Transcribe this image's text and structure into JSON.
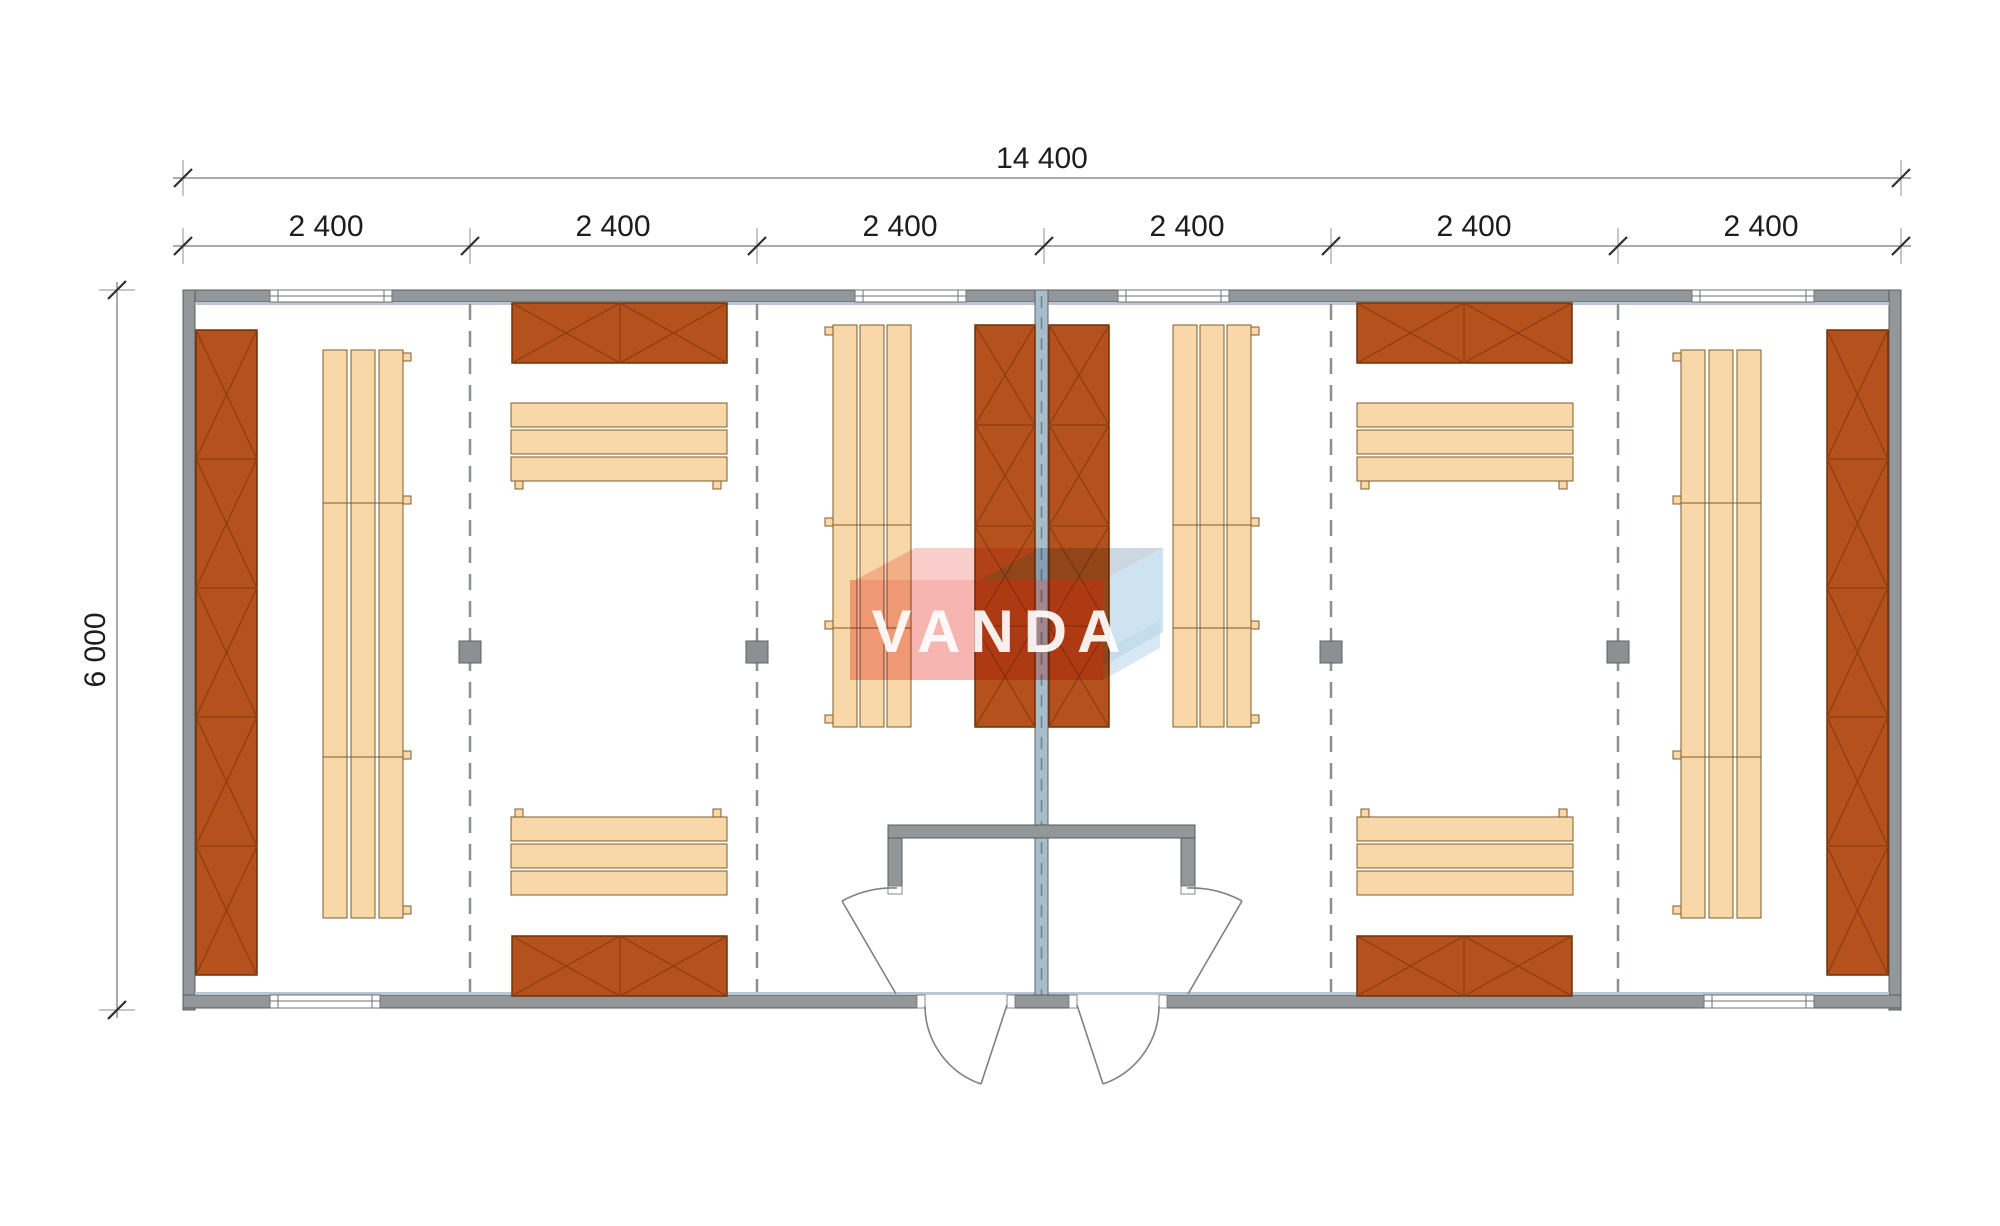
{
  "dimensions": {
    "overall_width": {
      "label": "14 400"
    },
    "modules": [
      {
        "label": "2 400"
      },
      {
        "label": "2 400"
      },
      {
        "label": "2 400"
      },
      {
        "label": "2 400"
      },
      {
        "label": "2 400"
      },
      {
        "label": "2 400"
      }
    ],
    "overall_depth": {
      "label": "6 000"
    }
  },
  "watermark": {
    "text": "VANDA"
  },
  "colors": {
    "wall": "#94979a",
    "wall_outline": "#585b5e",
    "wall_inner_face": "#b8c7d3",
    "party_wall": "#a9bcca",
    "locker_fill": "#b5511c",
    "locker_outline": "#6f3008",
    "bench_fill": "#f8d8a8",
    "bench_outline": "#7d5c28",
    "divider_dash": "#8d9093",
    "dimension_line": "#8f8f8f",
    "dimension_tick": "#2f2f2f",
    "watermark_red": "#ea5c50",
    "watermark_blue": "#bcd9ea"
  },
  "legend": {
    "locker_name": "wardrobe-locker-unit",
    "bench_name": "bench-unit",
    "post_name": "structural-post",
    "window_name": "window",
    "door_name": "door-swing"
  }
}
